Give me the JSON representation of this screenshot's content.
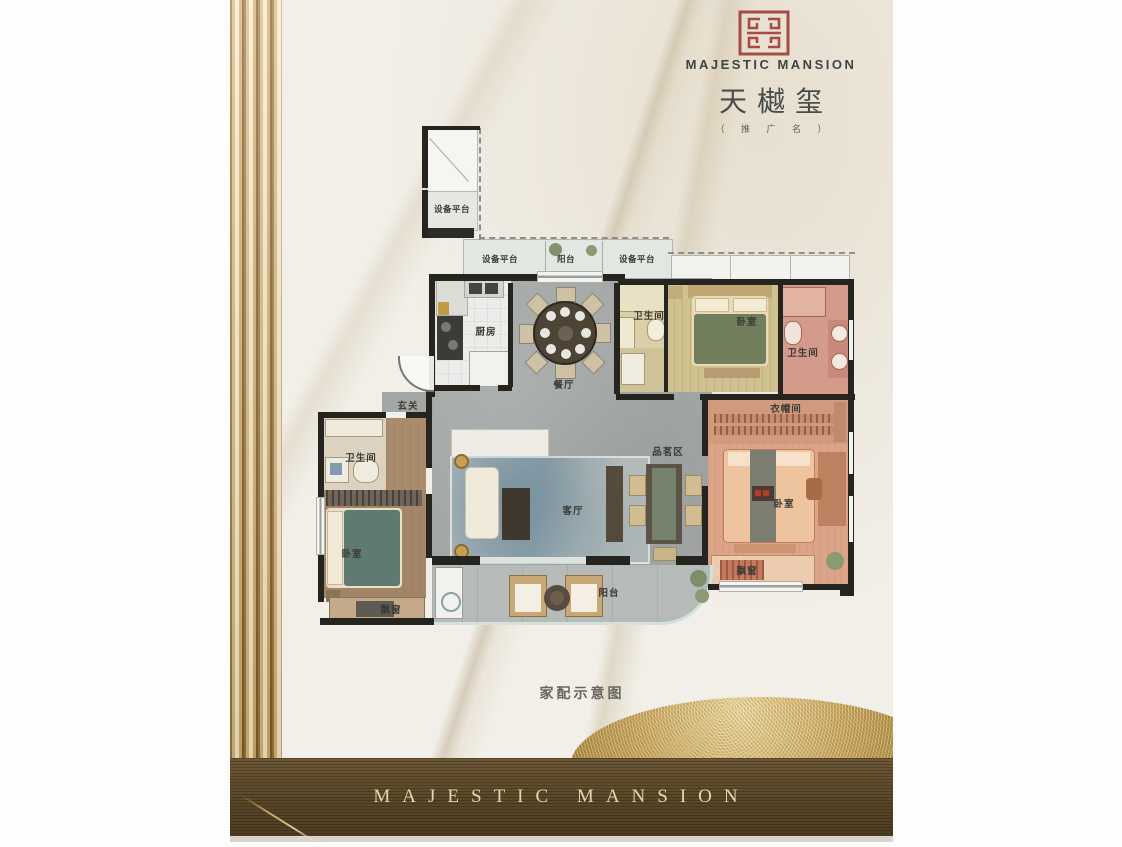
{
  "brand": {
    "seal_icon": "majestic-mansion-seal",
    "name_en": "MAJESTIC MANSION",
    "name_cn": "天樾玺",
    "name_note": "（ 推 广 名 ）"
  },
  "floorplan": {
    "caption": "家配示意图",
    "rooms": [
      {
        "name": "equipment-platform-tower",
        "label": "设备平台"
      },
      {
        "name": "equipment-platform-left",
        "label": "设备平台"
      },
      {
        "name": "balcony-north",
        "label": "阳台"
      },
      {
        "name": "equipment-platform-right",
        "label": "设备平台"
      },
      {
        "name": "kitchen",
        "label": "厨房"
      },
      {
        "name": "dining-room",
        "label": "餐厅"
      },
      {
        "name": "bathroom-north",
        "label": "卫生间"
      },
      {
        "name": "bedroom-north",
        "label": "卧室"
      },
      {
        "name": "bathroom-east",
        "label": "卫生间"
      },
      {
        "name": "foyer",
        "label": "玄关"
      },
      {
        "name": "bathroom-west",
        "label": "卫生间"
      },
      {
        "name": "tea-area",
        "label": "品茗区"
      },
      {
        "name": "living-room",
        "label": "客厅"
      },
      {
        "name": "cloakroom",
        "label": "衣帽间"
      },
      {
        "name": "bedroom-master",
        "label": "卧室"
      },
      {
        "name": "bay-window-master",
        "label": "飘窗"
      },
      {
        "name": "bedroom-west",
        "label": "卧室"
      },
      {
        "name": "bay-window-west",
        "label": "飘窗"
      },
      {
        "name": "balcony-south",
        "label": "阳台"
      }
    ]
  },
  "footer": {
    "text": "MAJESTIC MANSION"
  },
  "colors": {
    "seal_red": "#a94b45",
    "gold_accent": "#d7b878",
    "footer_brown": "#5a4728",
    "marble_background": "#f2efe8"
  }
}
